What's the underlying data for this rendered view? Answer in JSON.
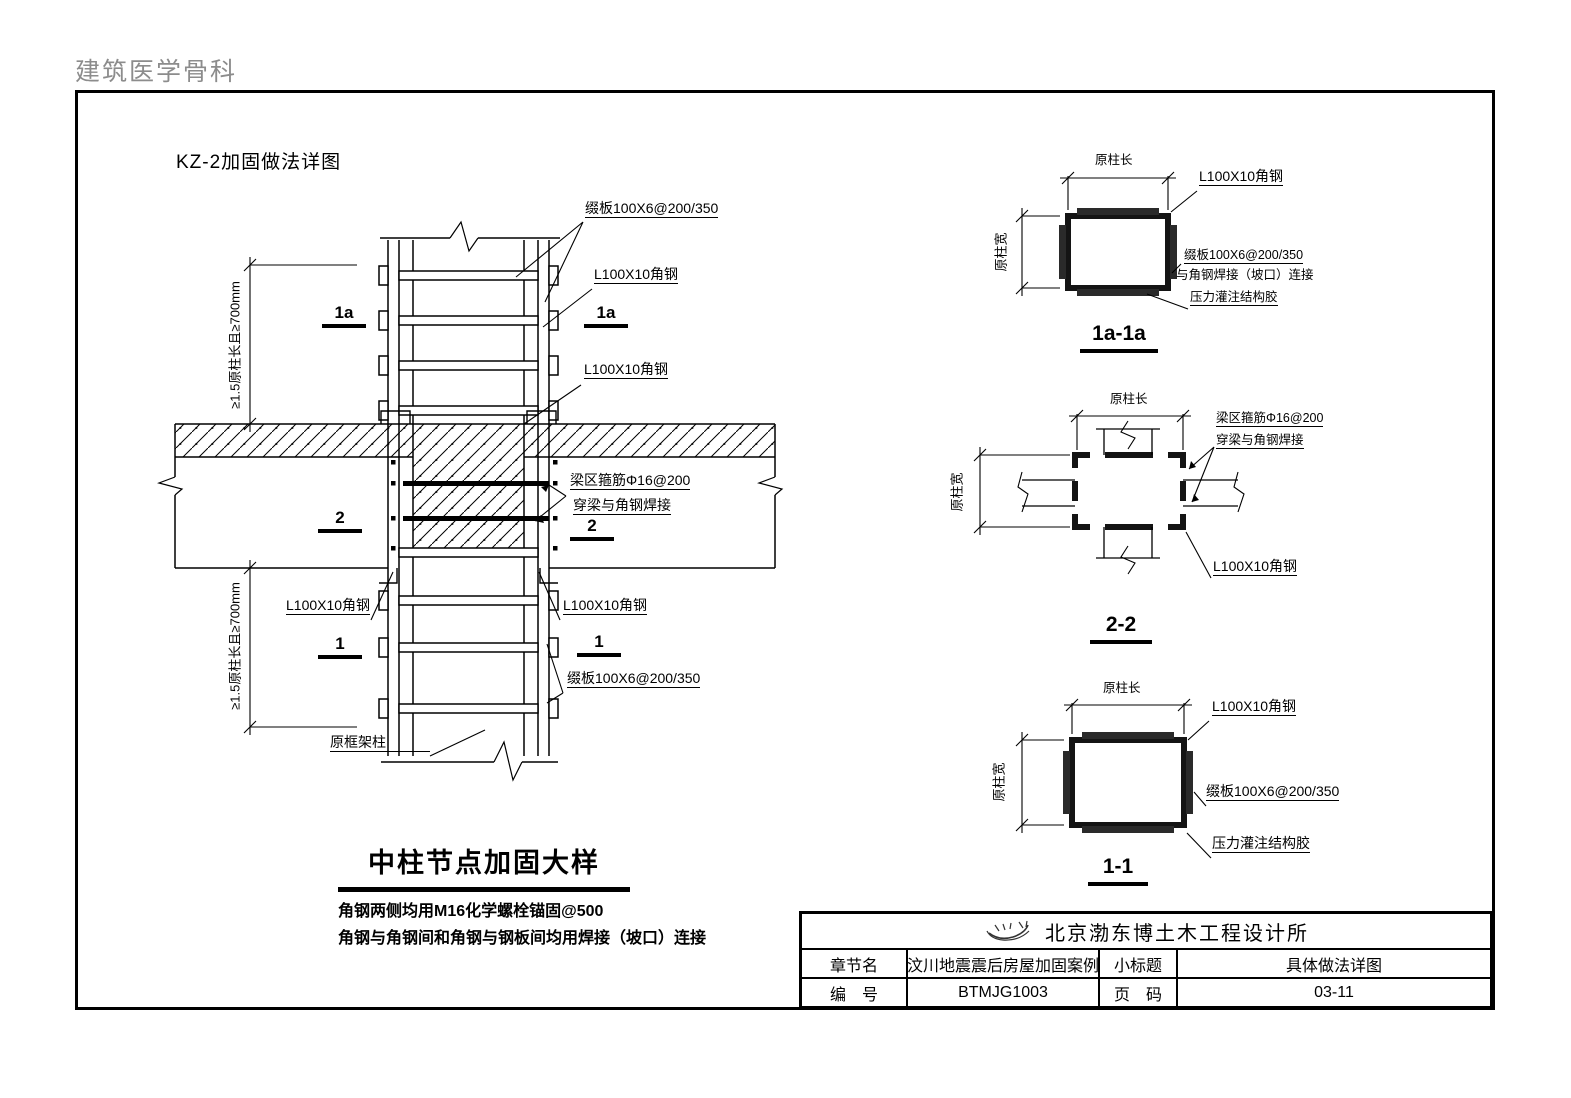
{
  "page": {
    "outside_header": "建筑医学骨科",
    "sheet_title": "KZ-2加固做法详图"
  },
  "elevation": {
    "labels": {
      "batten_top": "缀板100X6@200/350",
      "angle_top_right": "L100X10角钢",
      "angle_mid_right": "L100X10角钢",
      "stirrup_line1": "梁区箍筋Φ16@200",
      "stirrup_line2": "穿梁与角钢焊接",
      "angle_below_right": "L100X10角钢",
      "batten_bottom": "缀板100X6@200/350",
      "angle_left": "L100X10角钢",
      "orig_frame_column": "原框架柱"
    },
    "dims": {
      "upper": "≥1.5原柱长且≥700mm",
      "lower": "≥1.5原柱长且≥700mm"
    },
    "markers": {
      "m1a": "1a",
      "m2": "2",
      "m1": "1"
    },
    "title": "中柱节点加固大样",
    "notes": [
      "角钢两侧均用M16化学螺栓锚固@500",
      "角钢与角钢间和角钢与钢板间均用焊接（坡口）连接"
    ]
  },
  "sections": {
    "s1a": {
      "title": "1a-1a",
      "dim_top": "原柱长",
      "dim_left": "原柱宽",
      "label_angle": "L100X10角钢",
      "label_batten": "缀板100X6@200/350",
      "label_weld": "与角钢焊接（坡口）连接",
      "label_glue": "压力灌注结构胶"
    },
    "s2": {
      "title": "2-2",
      "dim_top": "原柱长",
      "dim_left": "原柱宽",
      "label_stirrup1": "梁区箍筋Φ16@200",
      "label_stirrup2": "穿梁与角钢焊接",
      "label_angle": "L100X10角钢"
    },
    "s1": {
      "title": "1-1",
      "dim_top": "原柱长",
      "dim_left": "原柱宽",
      "label_angle": "L100X10角钢",
      "label_batten": "缀板100X6@200/350",
      "label_glue": "压力灌注结构胶"
    }
  },
  "title_block": {
    "company": "北京渤东博土木工程设计所",
    "row1": {
      "label_a": "章节名",
      "value_a": "汶川地震震后房屋加固案例",
      "label_b": "小标题",
      "value_b": "具体做法详图"
    },
    "row2": {
      "label_a": "编　号",
      "value_a": "BTMJG1003",
      "label_b": "页　码",
      "value_b": "03-11"
    }
  }
}
